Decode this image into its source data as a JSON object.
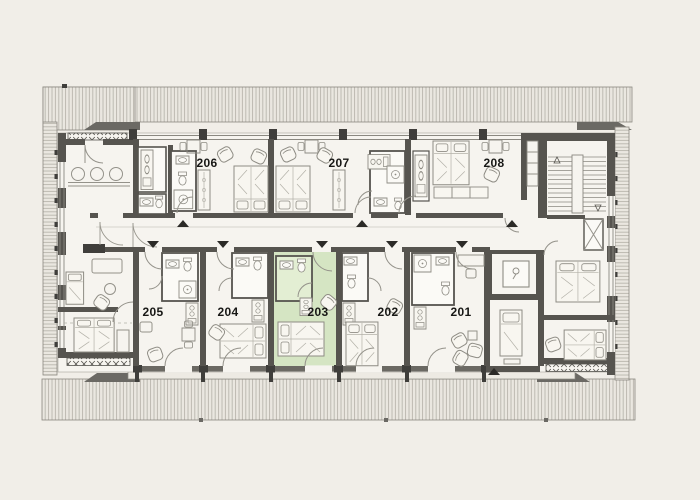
{
  "plan": {
    "kind": "hotel floor plan",
    "selected_room": "203",
    "rooms": {
      "r201": {
        "label": "201",
        "selected": false
      },
      "r202": {
        "label": "202",
        "selected": false
      },
      "r203": {
        "label": "203",
        "selected": true
      },
      "r204": {
        "label": "204",
        "selected": false
      },
      "r205": {
        "label": "205",
        "selected": false
      },
      "r206": {
        "label": "206",
        "selected": false
      },
      "r207": {
        "label": "207",
        "selected": false
      },
      "r208": {
        "label": "208",
        "selected": false
      }
    },
    "colors": {
      "background": "#f1eee8",
      "floor": "#f6f4ef",
      "wall": "#56544f",
      "roof_band": "#eae7e0",
      "hatch_line": "#aaa79e",
      "furniture_line": "#94928a",
      "selected_room_fill": "#d5e5c3",
      "selected_room_bath_fill": "#e3eed3",
      "label": "#181816",
      "arrow": "#2b2a27"
    },
    "icons": {
      "entry_arrow_up": "filled triangle pointing up",
      "entry_arrow_down": "filled triangle pointing down",
      "stairs": "parallel treads with direction marks",
      "elevator": "shaft with cab symbol",
      "railing": "row of x-braces"
    }
  }
}
